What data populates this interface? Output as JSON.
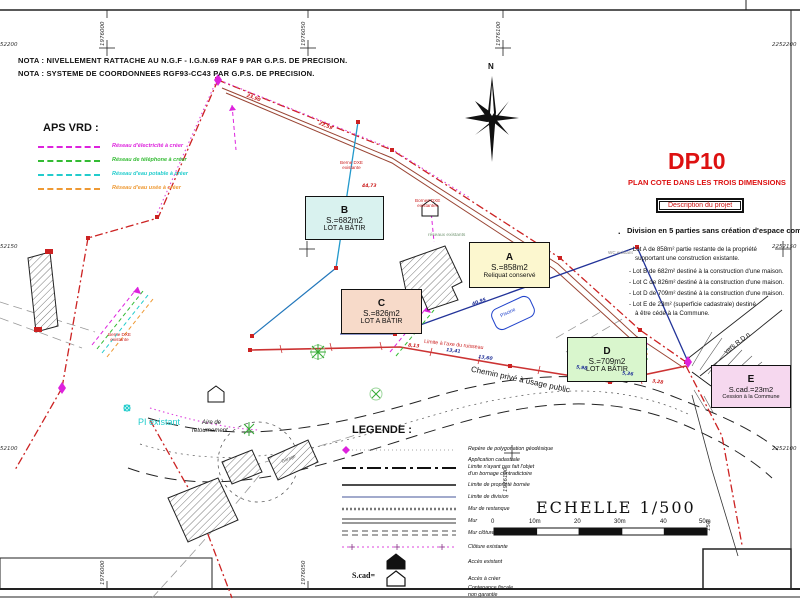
{
  "accent": "#dd1111",
  "notes": {
    "line1": "NOTA : NIVELLEMENT RATTACHE AU N.G.F - I.G.N.69 RAF 9 PAR G.P.S. DE PRECISION.",
    "line2": "NOTA : SYSTEME DE COORDONNEES RGF93-CC43 PAR G.P.S. DE PRECISION."
  },
  "grid": {
    "easting_top": [
      "1976000",
      "1976050",
      "1976100"
    ],
    "easting_bottom": [
      "1976000",
      "1976050",
      "1976100",
      "150"
    ],
    "northing_left": [
      "52200",
      "52150",
      "52100"
    ],
    "northing_right": [
      "2252200",
      "2252150",
      "2252100"
    ]
  },
  "aps_vrd": {
    "title": "APS VRD :",
    "items": [
      {
        "label": "Réseau d'électricité à créer",
        "color": "#dd22dd"
      },
      {
        "label": "Réseau de téléphone à créer",
        "color": "#33bb33"
      },
      {
        "label": "Réseau d'eau potable à créer",
        "color": "#22cccc"
      },
      {
        "label": "Réseau d'eau usée à créer",
        "color": "#ee9933"
      }
    ]
  },
  "title_block": {
    "code": "DP10",
    "title": "PLAN COTE DANS LES TROIS DIMENSIONS",
    "box_label": "Description du projet"
  },
  "project": {
    "heading": "Division en 5 parties sans création d'espace commun :",
    "lines": [
      "- Lot A de 858m² partie restante de la propriété",
      "supportant une construction existante.",
      "- Lot B de 682m² destiné à la construction d'une maison.",
      "- Lot C de 826m² destiné à la construction d'une maison.",
      "- Lot D de 709m² destiné à la construction d'une maison.",
      "- Lot E de  23m² (superficie cadastrale) destiné",
      "à être cédé à la Commune."
    ]
  },
  "lots": [
    {
      "id": "B",
      "area": "S.=682m2",
      "desc": "LOT A BÂTIR",
      "fill": "#d9f2ef"
    },
    {
      "id": "A",
      "area": "S.=858m2",
      "desc": "Reliquat conservé",
      "fill": "#fcf7cf"
    },
    {
      "id": "C",
      "area": "S.=826m2",
      "desc": "LOT A BÂTIR",
      "fill": "#f7dac9"
    },
    {
      "id": "D",
      "area": "S.=709m2",
      "desc": "LOT A BÂTIR",
      "fill": "#d9f6cd"
    },
    {
      "id": "E",
      "area": "S.cad.=23m2",
      "desc": "Cession à la Commune",
      "fill": "#f6d8ef"
    }
  ],
  "legend": {
    "title": "LEGENDE :",
    "items": [
      {
        "lines": [
          "Repère de polygonation géodésique"
        ]
      },
      {
        "lines": [
          "Application cadastrale",
          "Limite n'ayant pas fait l'objet",
          "d'un bornage contradictoire"
        ]
      },
      {
        "lines": [
          "Limite de propriété bornée"
        ]
      },
      {
        "lines": [
          "Limite de division"
        ]
      },
      {
        "lines": [
          "Mur de restanque"
        ]
      },
      {
        "lines": [
          "Mur"
        ]
      },
      {
        "lines": [
          "Mur clôture"
        ]
      },
      {
        "lines": [
          "Clôture existante"
        ]
      },
      {
        "lines": [
          "Accès existant"
        ]
      },
      {
        "lines": [
          "Accès à créer"
        ]
      },
      {
        "lines": [
          "Contenance fiscale",
          "non garantie"
        ]
      }
    ],
    "scad_label": "S.cad="
  },
  "scale": {
    "label": "ECHELLE  1/500",
    "ticks": [
      "0",
      "10m",
      "20",
      "30m",
      "40",
      "50m"
    ]
  },
  "map_labels": {
    "north": "N",
    "road": "Chemin privé à usage public",
    "stream": "Limite à l'axe du ruisseau",
    "hydrant": "PI existant",
    "turnaround1": "Aire de",
    "turnaround2": "retournement",
    "to_road": "vers R.D.n",
    "pool": "Piscine",
    "berne1a": "Berne DXE",
    "berne1b": "existante",
    "berne2a": "Bornes DXE",
    "berne2b": "existantes",
    "berne3a": "Berne DXE",
    "berne3b": "existante",
    "networks": "réseaux existants",
    "wc": "WC existant",
    "garage": "Garage"
  },
  "dimensions": [
    "23,90",
    "22,59",
    "44,73",
    "40,95",
    "13,41",
    "13,60",
    "5,98",
    "5,36",
    "8,13",
    "3,28"
  ]
}
